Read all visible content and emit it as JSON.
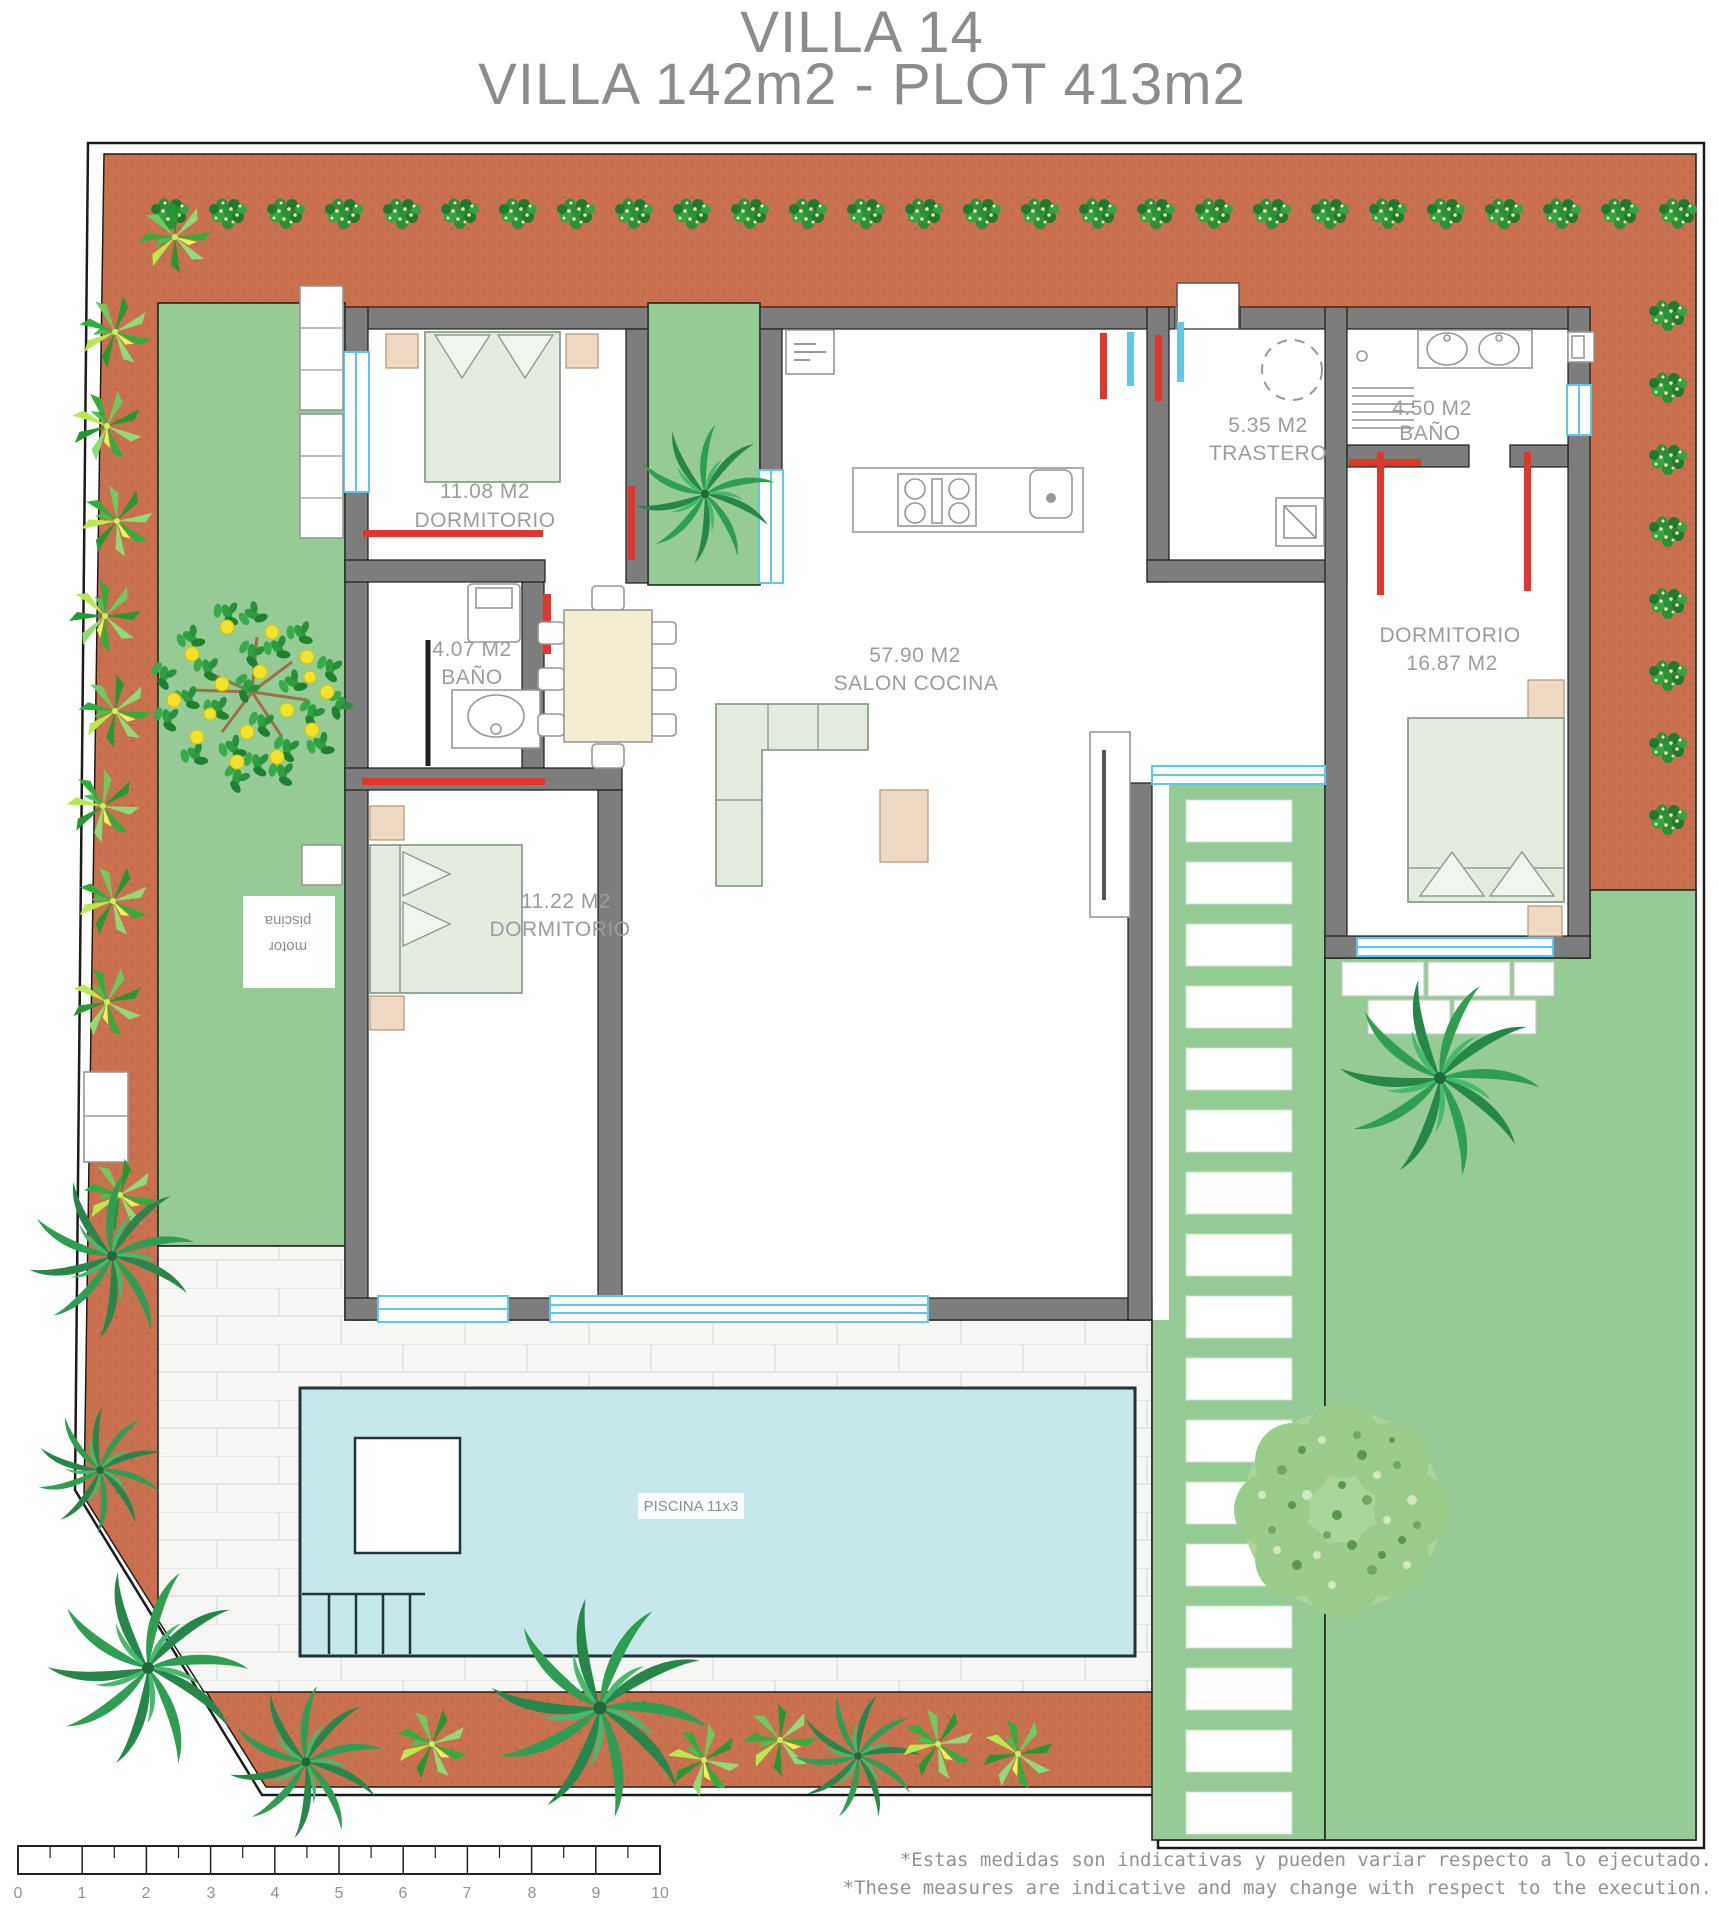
{
  "title": {
    "line1": "VILLA 14",
    "line2": "VILLA 142m2 - PLOT 413m2"
  },
  "rooms": {
    "dormitorio1": {
      "area": "11.08 M2",
      "name": "DORMITORIO"
    },
    "bano1": {
      "area": "4.07 M2",
      "name": "BAÑO"
    },
    "dormitorio2": {
      "area": "11.22 M2",
      "name": "DORMITORIO"
    },
    "salon": {
      "area": "57.90 M2",
      "name": "SALON COCINA"
    },
    "trastero": {
      "area": "5.35 M2",
      "name": "TRASTERO"
    },
    "bano2": {
      "area": "4.50 M2",
      "name": "BAÑO"
    },
    "dormitorio3": {
      "name": "DORMITORIO",
      "area": "16.87 M2"
    }
  },
  "pool": {
    "label": "PISCINA 11x3",
    "motor_line1": "motor",
    "motor_line2": "piscina"
  },
  "notes": {
    "es": "*Estas medidas son indicativas y pueden variar respecto a lo ejecutado.",
    "en": "*These measures are indicative and may change with respect to the execution."
  },
  "scale_bar": {
    "labels": [
      "0",
      "1",
      "2",
      "3",
      "4",
      "5",
      "6",
      "7",
      "8",
      "9",
      "10"
    ]
  },
  "colors": {
    "terracotta": "#c9714e",
    "garden_green": "#95cc95",
    "pool_blue": "#c6e8eb",
    "wall_gray": "#7d7d7d",
    "window_cyan": "#5fc8e6",
    "door_red": "#e0362c",
    "label_gray": "#9c9c9c"
  }
}
